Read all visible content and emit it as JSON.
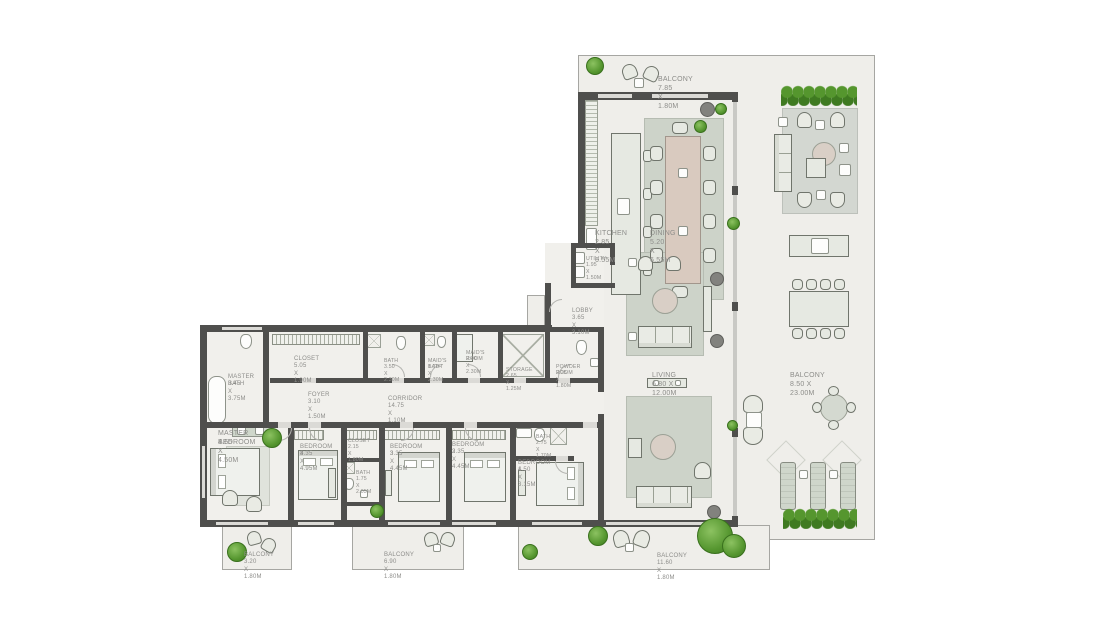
{
  "plan": {
    "rooms": {
      "balcony_top": {
        "name": "BALCONY",
        "dims": "7.85 X 1.80M"
      },
      "kitchen": {
        "name": "KITCHEN",
        "dims": "2.85 X 6.55M"
      },
      "dining": {
        "name": "DINING",
        "dims": "5.20 X 6.55M"
      },
      "utility": {
        "name": "UTILITY",
        "dims": "1.95 X\n1.50M"
      },
      "lobby": {
        "name": "LOBBY",
        "dims": "3.65 X\n3.10M"
      },
      "living": {
        "name": "LIVING",
        "dims": "6.80 X 12.00M"
      },
      "balcony_right": {
        "name": "BALCONY",
        "dims": "8.50 X 23.00M"
      },
      "master_bath": {
        "name": "MASTER\nBATH",
        "dims": "3.45 X 3.75M"
      },
      "closet_long": {
        "name": "CLOSET",
        "dims": "5.05 X 1.90M"
      },
      "foyer": {
        "name": "FOYER",
        "dims": "3.10 X 1.50M"
      },
      "bath_main": {
        "name": "BATH",
        "dims": "3.50 X\n2.30M"
      },
      "maids_bath": {
        "name": "MAID'S\nBATH",
        "dims": "1.70 X 2.30M"
      },
      "maids_room": {
        "name": "MAID'S\nROOM",
        "dims": "2.40 X\n2.30M"
      },
      "storage": {
        "name": "STORAGE",
        "dims": "2.65 X 1.25M"
      },
      "powder_room": {
        "name": "POWDER\nROOM",
        "dims": "2.25 X\n1.80M"
      },
      "corridor": {
        "name": "CORRIDOR",
        "dims": "14.75 X 1.10M"
      },
      "master_bedroom": {
        "name": "MASTER BEDROOM",
        "dims": "4.65 X 4.50M"
      },
      "bedroom4": {
        "name": "BEDROOM 4",
        "dims": "3.35 X 4.95M"
      },
      "closet_small": {
        "name": "CLOSET",
        "dims": "2.15 X\n1.80M"
      },
      "bath_small": {
        "name": "BATH",
        "dims": "1.75 X\n2.05M"
      },
      "bedroom3": {
        "name": "BEDROOM 3",
        "dims": "3.35 X 4.45M"
      },
      "bedroom2": {
        "name": "BEDROOM 2",
        "dims": "3.35 X 4.45M"
      },
      "bath_shared": {
        "name": "BATH",
        "dims": "2.75 X 1.70M"
      },
      "bedroom1": {
        "name": "BEDROOM 1",
        "dims": "4.50 X\n3.15M"
      },
      "balcony_b1": {
        "name": "BALCONY",
        "dims": "3.20 X 1.80M"
      },
      "balcony_b2": {
        "name": "BALCONY",
        "dims": "6.90 X 1.80M"
      },
      "balcony_b3": {
        "name": "BALCONY",
        "dims": "11.60 X 1.80M"
      }
    },
    "colors": {
      "wall": "#4f4f4d",
      "floor": "#f1f0ec",
      "rug": "#cdd3c9",
      "outdoor_rug": "#d3d7d1",
      "furniture": "#e6e9e2",
      "wood": "#d9cabf",
      "plant": "#4e9028",
      "label": "#8d8d8a"
    }
  }
}
